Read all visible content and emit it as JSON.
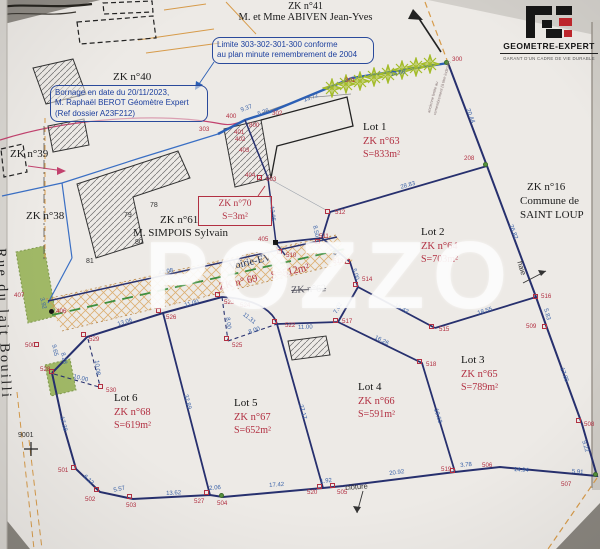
{
  "header": {
    "parcel": "ZK n°41",
    "owner": "M. et Mme ABIVEN Jean-Yves"
  },
  "logo": {
    "name": "GEOMETRE-EXPERT",
    "tagline": "GARANT D'UN CADRE DE VIE DURABLE"
  },
  "watermark": "POZZO",
  "colors": {
    "boundary_navy": "#27306e",
    "hedge_blue": "#2b5fb5",
    "point_red": "#b23042",
    "measure_blue": "#3a62a8",
    "road_orange": "#d79b4a",
    "vegetation_green": "#93b050",
    "logo_red": "#c0272d"
  },
  "notes": {
    "limite": {
      "lines": [
        "Limite 303-302-301-300 conforme",
        "au plan minute remembrement de 2004"
      ]
    },
    "bornage": {
      "lines": [
        "Bornage en date du 20/11/2023,",
        "M. Raphaël BEROT Géomètre Expert",
        "(Ref dossier A23F212)"
      ]
    },
    "zk70": {
      "lines": [
        "ZK n°70",
        "S=3m²"
      ]
    }
  },
  "plan": {
    "lots": [
      {
        "name": "Lot 1",
        "zk": "ZK n°63",
        "area": "S=833m²",
        "x": 363,
        "y": 121
      },
      {
        "name": "Lot 2",
        "zk": "ZK n°64",
        "area": "S=703m²",
        "x": 421,
        "y": 226
      },
      {
        "name": "Lot 3",
        "zk": "ZK n°65",
        "area": "S=789m²",
        "x": 461,
        "y": 354
      },
      {
        "name": "Lot 4",
        "zk": "ZK n°66",
        "area": "S=591m²",
        "x": 358,
        "y": 381
      },
      {
        "name": "Lot 5",
        "zk": "ZK n°67",
        "area": "S=652m²",
        "x": 234,
        "y": 397
      },
      {
        "name": "Lot 6",
        "zk": "ZK n°68",
        "area": "S=619m²",
        "x": 114,
        "y": 392
      }
    ],
    "texts": [
      {
        "t": "ZK n°40",
        "cls": "parcel",
        "x": 113,
        "y": 71
      },
      {
        "t": "ZK n°39",
        "cls": "parcel",
        "x": 10,
        "y": 148
      },
      {
        "t": "ZK n°38",
        "cls": "parcel",
        "x": 26,
        "y": 210
      },
      {
        "t": "ZK n°61",
        "cls": "parcel",
        "x": 160,
        "y": 214
      },
      {
        "t": "M. SIMPOIS Sylvain",
        "cls": "parcel",
        "x": 133,
        "y": 227
      },
      {
        "t": "ZK n°16",
        "cls": "parcel",
        "x": 527,
        "y": 181
      },
      {
        "t": "Commune de",
        "cls": "parcel",
        "x": 520,
        "y": 195
      },
      {
        "t": "SAINT LOUP",
        "cls": "parcel",
        "x": 520,
        "y": 209
      },
      {
        "t": "Voirie-EV",
        "cls": "voirie",
        "x": 228,
        "y": 262,
        "r": -13
      },
      {
        "t": "ZK n° 69",
        "cls": "voirie red",
        "x": 218,
        "y": 282,
        "r": -13
      },
      {
        "t": "S=512m²",
        "cls": "voirie red",
        "x": 270,
        "y": 271,
        "r": -13
      },
      {
        "t": "ZK n°62",
        "cls": "strike",
        "x": 291,
        "y": 285,
        "r": -3
      },
      {
        "t": "haie",
        "cls": "annot",
        "x": 524,
        "y": 260,
        "r": 73
      },
      {
        "t": "clôture",
        "cls": "annot",
        "x": 345,
        "y": 483,
        "r": -4
      },
      {
        "t": "ancienne limite au",
        "cls": "tiny",
        "x": 426,
        "y": 112,
        "r": -75
      },
      {
        "t": "remembrement (à titre indicatif)",
        "cls": "tiny",
        "x": 432,
        "y": 114,
        "r": -75
      },
      {
        "t": "78",
        "cls": "bnum",
        "x": 150,
        "y": 202
      },
      {
        "t": "79",
        "cls": "bnum",
        "x": 124,
        "y": 212
      },
      {
        "t": "80",
        "cls": "bnum",
        "x": 135,
        "y": 239
      },
      {
        "t": "81",
        "cls": "bnum",
        "x": 86,
        "y": 258
      },
      {
        "t": "9001",
        "cls": "bnum",
        "x": 18,
        "y": 432
      },
      {
        "t": "Rue du lait Bouilli",
        "cls": "street",
        "x": 8,
        "y": 248,
        "r": 88
      }
    ],
    "points": [
      {
        "id": "300",
        "x": 452,
        "y": 56,
        "m": "dot",
        "mx": 446,
        "my": 62
      },
      {
        "id": "301",
        "x": 345,
        "y": 77
      },
      {
        "id": "302",
        "x": 272,
        "y": 110
      },
      {
        "id": "303",
        "x": 199,
        "y": 126
      },
      {
        "id": "400",
        "x": 226,
        "y": 113
      },
      {
        "id": "800",
        "x": 249,
        "y": 122
      },
      {
        "id": "401",
        "x": 234,
        "y": 129
      },
      {
        "id": "402",
        "x": 235,
        "y": 136
      },
      {
        "id": "403",
        "x": 239,
        "y": 147
      },
      {
        "id": "404",
        "x": 245,
        "y": 172
      },
      {
        "id": "603",
        "x": 266,
        "y": 176,
        "m": "sq",
        "mx": 259,
        "my": 177
      },
      {
        "id": "405",
        "x": 258,
        "y": 236,
        "m": "blk",
        "mx": 275,
        "my": 242
      },
      {
        "id": "510",
        "x": 286,
        "y": 252,
        "m": "sq",
        "mx": 279,
        "my": 251
      },
      {
        "id": "511",
        "x": 319,
        "y": 233,
        "m": "sq",
        "mx": 317,
        "my": 241
      },
      {
        "id": "512",
        "x": 335,
        "y": 209,
        "m": "sq",
        "mx": 327,
        "my": 211
      },
      {
        "id": "513",
        "x": 333,
        "y": 258,
        "m": "sq",
        "mx": 347,
        "my": 261
      },
      {
        "id": "514",
        "x": 362,
        "y": 276,
        "m": "sq",
        "mx": 355,
        "my": 284
      },
      {
        "id": "515",
        "x": 439,
        "y": 326,
        "m": "sq",
        "mx": 431,
        "my": 326
      },
      {
        "id": "516",
        "x": 541,
        "y": 293,
        "m": "sq",
        "mx": 535,
        "my": 296
      },
      {
        "id": "517",
        "x": 342,
        "y": 318,
        "m": "sq",
        "mx": 335,
        "my": 320
      },
      {
        "id": "518",
        "x": 426,
        "y": 361,
        "m": "sq",
        "mx": 419,
        "my": 361
      },
      {
        "id": "519",
        "x": 441,
        "y": 466,
        "m": "sq",
        "mx": 452,
        "my": 470
      },
      {
        "id": "520",
        "x": 307,
        "y": 489,
        "m": "sq",
        "mx": 319,
        "my": 486
      },
      {
        "id": "505",
        "x": 337,
        "y": 489,
        "m": "sq",
        "mx": 332,
        "my": 485
      },
      {
        "id": "504",
        "x": 217,
        "y": 500,
        "m": "dot",
        "mx": 221,
        "my": 495
      },
      {
        "id": "527",
        "x": 194,
        "y": 498,
        "m": "sq",
        "mx": 206,
        "my": 492
      },
      {
        "id": "503",
        "x": 126,
        "y": 502,
        "m": "sq",
        "mx": 129,
        "my": 496
      },
      {
        "id": "502",
        "x": 85,
        "y": 496,
        "m": "sq",
        "mx": 96,
        "my": 489
      },
      {
        "id": "501",
        "x": 58,
        "y": 467,
        "m": "sq",
        "mx": 73,
        "my": 467
      },
      {
        "id": "500",
        "x": 25,
        "y": 342,
        "m": "sq",
        "mx": 36,
        "my": 344
      },
      {
        "id": "528",
        "x": 40,
        "y": 366,
        "m": "sq",
        "mx": 51,
        "my": 371
      },
      {
        "id": "529",
        "x": 89,
        "y": 336,
        "m": "sq",
        "mx": 83,
        "my": 334
      },
      {
        "id": "530",
        "x": 106,
        "y": 387,
        "m": "sq",
        "mx": 100,
        "my": 386
      },
      {
        "id": "526",
        "x": 166,
        "y": 314,
        "m": "sq",
        "mx": 158,
        "my": 310
      },
      {
        "id": "525",
        "x": 232,
        "y": 342,
        "m": "sq",
        "mx": 226,
        "my": 338
      },
      {
        "id": "523",
        "x": 224,
        "y": 299,
        "m": "sq",
        "mx": 217,
        "my": 294
      },
      {
        "id": "524",
        "x": 240,
        "y": 302
      },
      {
        "id": "522",
        "x": 285,
        "y": 322,
        "m": "sq",
        "mx": 274,
        "my": 321
      },
      {
        "id": "506",
        "x": 482,
        "y": 462
      },
      {
        "id": "507",
        "x": 561,
        "y": 481,
        "m": "dot",
        "mx": 595,
        "my": 474
      },
      {
        "id": "508",
        "x": 584,
        "y": 421,
        "m": "sq",
        "mx": 578,
        "my": 420
      },
      {
        "id": "509",
        "x": 526,
        "y": 323,
        "m": "sq",
        "mx": 544,
        "my": 326
      },
      {
        "id": "406",
        "x": 56,
        "y": 308,
        "m": "bdot",
        "mx": 51,
        "my": 311
      },
      {
        "id": "407",
        "x": 14,
        "y": 292
      },
      {
        "id": "208",
        "x": 464,
        "y": 155,
        "m": "dot",
        "mx": 485,
        "my": 164
      }
    ],
    "measurements": [
      {
        "t": "20.44",
        "x": 470,
        "y": 108,
        "r": 69
      },
      {
        "t": "13.72",
        "x": 303,
        "y": 98,
        "r": -20
      },
      {
        "t": "13.86",
        "x": 390,
        "y": 72,
        "r": -10
      },
      {
        "t": "9.37",
        "x": 240,
        "y": 108,
        "r": -20
      },
      {
        "t": "5.26",
        "x": 257,
        "y": 112,
        "r": -20
      },
      {
        "t": "28.83",
        "x": 400,
        "y": 185,
        "r": -16
      },
      {
        "t": "8.50",
        "x": 317,
        "y": 225,
        "r": 78
      },
      {
        "t": "12.05",
        "x": 274,
        "y": 206,
        "r": 83
      },
      {
        "t": "26.82",
        "x": 513,
        "y": 224,
        "r": 69
      },
      {
        "t": "18.55",
        "x": 477,
        "y": 311,
        "r": -17
      },
      {
        "t": "5.83",
        "x": 548,
        "y": 308,
        "r": 75
      },
      {
        "t": "15.42",
        "x": 396,
        "y": 303,
        "r": 28
      },
      {
        "t": "7.67",
        "x": 332,
        "y": 247,
        "r": 45
      },
      {
        "t": "5.00",
        "x": 356,
        "y": 268,
        "r": 72
      },
      {
        "t": "7.02",
        "x": 333,
        "y": 312,
        "r": -60
      },
      {
        "t": "11.00",
        "x": 298,
        "y": 325,
        "r": -2
      },
      {
        "t": "8.00",
        "x": 248,
        "y": 330,
        "r": -19
      },
      {
        "t": "11.31",
        "x": 245,
        "y": 312,
        "r": 38
      },
      {
        "t": "8.00",
        "x": 230,
        "y": 317,
        "r": 83
      },
      {
        "t": "11.00",
        "x": 184,
        "y": 303,
        "r": -15
      },
      {
        "t": "13.06",
        "x": 117,
        "y": 322,
        "r": -17
      },
      {
        "t": "9.65",
        "x": 56,
        "y": 344,
        "r": 78
      },
      {
        "t": "8.28",
        "x": 65,
        "y": 352,
        "r": 78
      },
      {
        "t": "10.08",
        "x": 99,
        "y": 360,
        "r": 84
      },
      {
        "t": "10.00",
        "x": 74,
        "y": 374,
        "r": 14
      },
      {
        "t": "42.08",
        "x": 158,
        "y": 271,
        "r": -12
      },
      {
        "t": "3.92",
        "x": 44,
        "y": 297,
        "r": 76
      },
      {
        "t": "17.38",
        "x": 64,
        "y": 416,
        "r": 76
      },
      {
        "t": "6.12",
        "x": 86,
        "y": 474,
        "r": 44
      },
      {
        "t": "5.57",
        "x": 113,
        "y": 488,
        "r": -12
      },
      {
        "t": "13.62",
        "x": 166,
        "y": 491,
        "r": -3
      },
      {
        "t": "2.06",
        "x": 209,
        "y": 486,
        "r": -5
      },
      {
        "t": "17.42",
        "x": 269,
        "y": 483,
        "r": -4
      },
      {
        "t": "1.92",
        "x": 320,
        "y": 479,
        "r": -5
      },
      {
        "t": "20.92",
        "x": 389,
        "y": 471,
        "r": -7
      },
      {
        "t": "3.78",
        "x": 460,
        "y": 463,
        "r": -5
      },
      {
        "t": "14.94",
        "x": 514,
        "y": 467,
        "r": 4
      },
      {
        "t": "5.91",
        "x": 572,
        "y": 469,
        "r": 4
      },
      {
        "t": "9.22",
        "x": 586,
        "y": 440,
        "r": 74
      },
      {
        "t": "17.85",
        "x": 564,
        "y": 367,
        "r": 70
      },
      {
        "t": "16.26",
        "x": 376,
        "y": 335,
        "r": 26
      },
      {
        "t": "19.63",
        "x": 438,
        "y": 408,
        "r": 73
      },
      {
        "t": "32.89",
        "x": 188,
        "y": 394,
        "r": 75
      },
      {
        "t": "27.17",
        "x": 303,
        "y": 404,
        "r": 74
      }
    ]
  }
}
